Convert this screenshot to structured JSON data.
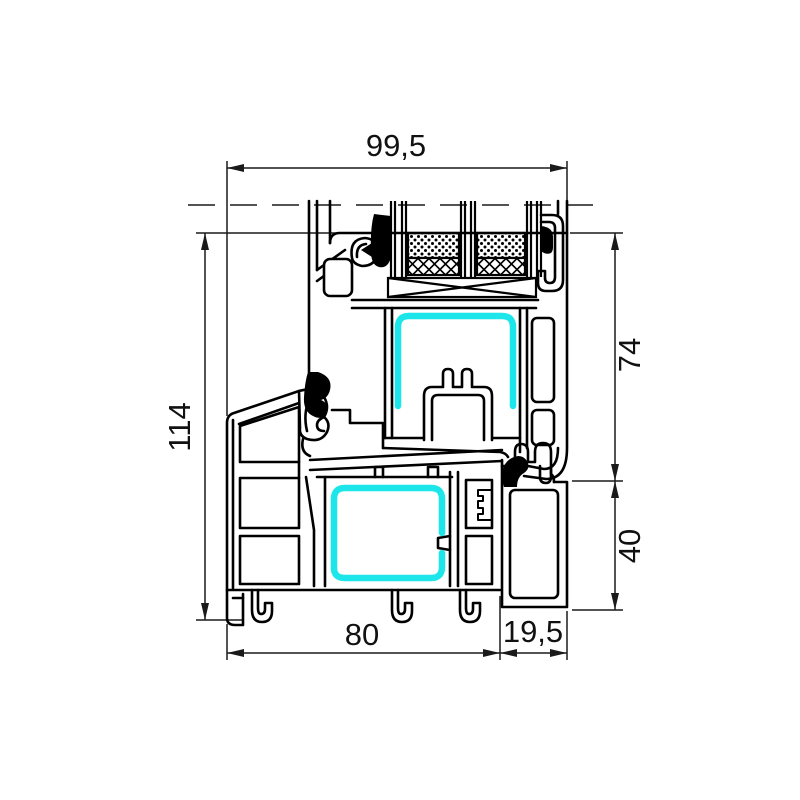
{
  "drawing": {
    "dimensions": {
      "top_width": "99,5",
      "overall_height": "114",
      "sash_height": "74",
      "frame_lower_height": "40",
      "frame_bottom_width": "80",
      "frame_offset_width": "19,5"
    },
    "colors": {
      "outline": "#000000",
      "dimension_lines": "#1a1a1a",
      "reinforcement_highlight": "#1ce6ea",
      "gasket": "#000000",
      "background": "#ffffff"
    }
  }
}
